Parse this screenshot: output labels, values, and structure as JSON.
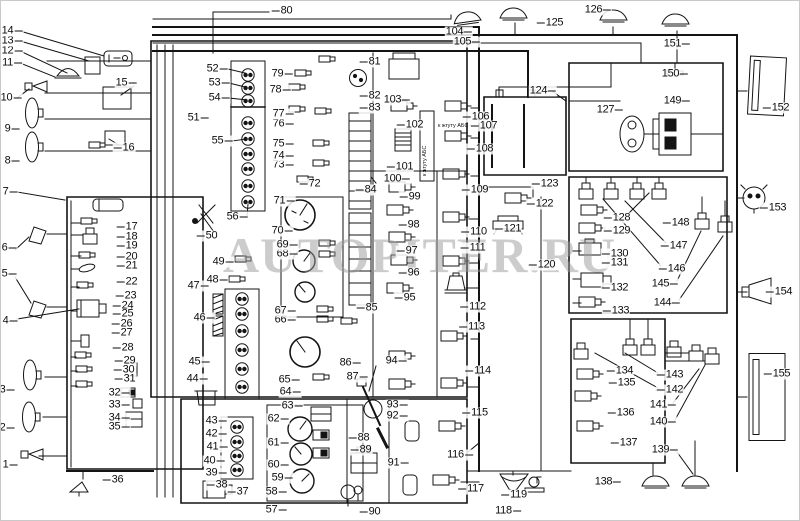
{
  "watermark": "AUTOPITER.RU",
  "colors": {
    "line": "#141414",
    "background": "#ffffff",
    "watermark": "#9a9a9a"
  },
  "annotations": [
    {
      "text": "к жгуту АБС",
      "x": 437,
      "y": 123,
      "rot": 0
    },
    {
      "text": "к жгуту АБС",
      "x": 422,
      "y": 175,
      "rot": -90
    }
  ],
  "labels": [
    {
      "n": "1",
      "x": 9,
      "y": 464,
      "s": "r"
    },
    {
      "n": "2",
      "x": 6,
      "y": 427,
      "s": "r"
    },
    {
      "n": "3",
      "x": 6,
      "y": 389,
      "s": "r"
    },
    {
      "n": "4",
      "x": 9,
      "y": 320,
      "s": "r"
    },
    {
      "n": "5",
      "x": 8,
      "y": 273,
      "s": "r"
    },
    {
      "n": "6",
      "x": 8,
      "y": 247,
      "s": "r"
    },
    {
      "n": "7",
      "x": 9,
      "y": 191,
      "s": "r"
    },
    {
      "n": "8",
      "x": 11,
      "y": 160,
      "s": "r"
    },
    {
      "n": "9",
      "x": 11,
      "y": 128,
      "s": "r"
    },
    {
      "n": "10",
      "x": 10,
      "y": 97,
      "s": "r"
    },
    {
      "n": "11",
      "x": 11,
      "y": 62,
      "s": "r"
    },
    {
      "n": "12",
      "x": 11,
      "y": 50,
      "s": "r"
    },
    {
      "n": "13",
      "x": 11,
      "y": 40,
      "s": "r"
    },
    {
      "n": "14",
      "x": 11,
      "y": 30,
      "s": "r"
    },
    {
      "n": "15",
      "x": 125,
      "y": 82,
      "s": "r"
    },
    {
      "n": "16",
      "x": 123,
      "y": 147,
      "s": "l"
    },
    {
      "n": "17",
      "x": 126,
      "y": 226,
      "s": "l"
    },
    {
      "n": "18",
      "x": 126,
      "y": 236,
      "s": "l"
    },
    {
      "n": "19",
      "x": 126,
      "y": 245,
      "s": "l"
    },
    {
      "n": "20",
      "x": 126,
      "y": 256,
      "s": "l"
    },
    {
      "n": "21",
      "x": 126,
      "y": 265,
      "s": "l"
    },
    {
      "n": "22",
      "x": 126,
      "y": 281,
      "s": "l"
    },
    {
      "n": "23",
      "x": 125,
      "y": 295,
      "s": "l"
    },
    {
      "n": "24",
      "x": 122,
      "y": 305,
      "s": "l"
    },
    {
      "n": "25",
      "x": 122,
      "y": 313,
      "s": "l"
    },
    {
      "n": "26",
      "x": 121,
      "y": 323,
      "s": "l"
    },
    {
      "n": "27",
      "x": 121,
      "y": 332,
      "s": "l"
    },
    {
      "n": "28",
      "x": 122,
      "y": 347,
      "s": "l"
    },
    {
      "n": "29",
      "x": 124,
      "y": 360,
      "s": "l"
    },
    {
      "n": "30",
      "x": 123,
      "y": 369,
      "s": "l"
    },
    {
      "n": "31",
      "x": 124,
      "y": 378,
      "s": "l"
    },
    {
      "n": "32",
      "x": 118,
      "y": 392,
      "s": "r"
    },
    {
      "n": "33",
      "x": 118,
      "y": 404,
      "s": "r"
    },
    {
      "n": "34",
      "x": 118,
      "y": 417,
      "s": "r"
    },
    {
      "n": "35",
      "x": 118,
      "y": 426,
      "s": "r"
    },
    {
      "n": "36",
      "x": 112,
      "y": 479,
      "s": "l"
    },
    {
      "n": "37",
      "x": 237,
      "y": 491,
      "s": "l"
    },
    {
      "n": "38",
      "x": 216,
      "y": 484,
      "s": "l"
    },
    {
      "n": "39",
      "x": 215,
      "y": 472,
      "s": "r"
    },
    {
      "n": "40",
      "x": 213,
      "y": 460,
      "s": "r"
    },
    {
      "n": "41",
      "x": 216,
      "y": 446,
      "s": "r"
    },
    {
      "n": "42",
      "x": 215,
      "y": 433,
      "s": "r"
    },
    {
      "n": "43",
      "x": 215,
      "y": 420,
      "s": "r"
    },
    {
      "n": "44",
      "x": 196,
      "y": 378,
      "s": "r"
    },
    {
      "n": "45",
      "x": 198,
      "y": 361,
      "s": "r"
    },
    {
      "n": "46",
      "x": 203,
      "y": 317,
      "s": "r"
    },
    {
      "n": "47",
      "x": 197,
      "y": 285,
      "s": "r"
    },
    {
      "n": "48",
      "x": 216,
      "y": 279,
      "s": "r"
    },
    {
      "n": "49",
      "x": 222,
      "y": 261,
      "s": "r"
    },
    {
      "n": "50",
      "x": 206,
      "y": 235,
      "s": "l"
    },
    {
      "n": "51",
      "x": 197,
      "y": 117,
      "s": "r"
    },
    {
      "n": "52",
      "x": 216,
      "y": 68,
      "s": "r"
    },
    {
      "n": "53",
      "x": 218,
      "y": 82,
      "s": "r"
    },
    {
      "n": "54",
      "x": 218,
      "y": 97,
      "s": "r"
    },
    {
      "n": "55",
      "x": 221,
      "y": 140,
      "s": "r"
    },
    {
      "n": "56",
      "x": 236,
      "y": 216,
      "s": "r"
    },
    {
      "n": "57",
      "x": 275,
      "y": 509,
      "s": "r"
    },
    {
      "n": "58",
      "x": 275,
      "y": 491,
      "s": "r"
    },
    {
      "n": "59",
      "x": 281,
      "y": 477,
      "s": "r"
    },
    {
      "n": "60",
      "x": 277,
      "y": 464,
      "s": "r"
    },
    {
      "n": "61",
      "x": 277,
      "y": 442,
      "s": "r"
    },
    {
      "n": "62",
      "x": 277,
      "y": 418,
      "s": "r"
    },
    {
      "n": "63",
      "x": 291,
      "y": 405,
      "s": "r"
    },
    {
      "n": "64",
      "x": 289,
      "y": 391,
      "s": "r"
    },
    {
      "n": "65",
      "x": 288,
      "y": 379,
      "s": "r"
    },
    {
      "n": "66",
      "x": 284,
      "y": 319,
      "s": "r"
    },
    {
      "n": "67",
      "x": 284,
      "y": 310,
      "s": "r"
    },
    {
      "n": "68",
      "x": 286,
      "y": 253,
      "s": "r"
    },
    {
      "n": "69",
      "x": 286,
      "y": 244,
      "s": "r"
    },
    {
      "n": "70",
      "x": 281,
      "y": 230,
      "s": "r"
    },
    {
      "n": "71",
      "x": 283,
      "y": 200,
      "s": "r"
    },
    {
      "n": "72",
      "x": 309,
      "y": 183,
      "s": "l"
    },
    {
      "n": "73",
      "x": 282,
      "y": 164,
      "s": "r"
    },
    {
      "n": "74",
      "x": 282,
      "y": 155,
      "s": "r"
    },
    {
      "n": "75",
      "x": 282,
      "y": 143,
      "s": "r"
    },
    {
      "n": "76",
      "x": 282,
      "y": 123,
      "s": "r"
    },
    {
      "n": "77",
      "x": 282,
      "y": 113,
      "s": "r"
    },
    {
      "n": "78",
      "x": 279,
      "y": 89,
      "s": "r"
    },
    {
      "n": "79",
      "x": 281,
      "y": 73,
      "s": "r"
    },
    {
      "n": "80",
      "x": 281,
      "y": 10,
      "s": "l"
    },
    {
      "n": "81",
      "x": 369,
      "y": 61,
      "s": "l"
    },
    {
      "n": "82",
      "x": 369,
      "y": 95,
      "s": "l"
    },
    {
      "n": "83",
      "x": 369,
      "y": 107,
      "s": "l"
    },
    {
      "n": "84",
      "x": 365,
      "y": 189,
      "s": "l"
    },
    {
      "n": "85",
      "x": 366,
      "y": 307,
      "s": "l"
    },
    {
      "n": "86",
      "x": 349,
      "y": 362,
      "s": "r"
    },
    {
      "n": "87",
      "x": 356,
      "y": 376,
      "s": "r"
    },
    {
      "n": "88",
      "x": 358,
      "y": 437,
      "s": "l"
    },
    {
      "n": "89",
      "x": 360,
      "y": 449,
      "s": "l"
    },
    {
      "n": "90",
      "x": 369,
      "y": 511,
      "s": "l"
    },
    {
      "n": "91",
      "x": 397,
      "y": 462,
      "s": "r"
    },
    {
      "n": "92",
      "x": 396,
      "y": 415,
      "s": "r"
    },
    {
      "n": "93",
      "x": 396,
      "y": 404,
      "s": "r"
    },
    {
      "n": "94",
      "x": 395,
      "y": 360,
      "s": "r"
    },
    {
      "n": "95",
      "x": 404,
      "y": 297,
      "s": "l"
    },
    {
      "n": "96",
      "x": 408,
      "y": 272,
      "s": "l"
    },
    {
      "n": "97",
      "x": 406,
      "y": 250,
      "s": "l"
    },
    {
      "n": "98",
      "x": 408,
      "y": 224,
      "s": "l"
    },
    {
      "n": "99",
      "x": 409,
      "y": 196,
      "s": "l"
    },
    {
      "n": "100",
      "x": 396,
      "y": 178,
      "s": "r"
    },
    {
      "n": "101",
      "x": 399,
      "y": 166,
      "s": "l"
    },
    {
      "n": "102",
      "x": 409,
      "y": 124,
      "s": "l"
    },
    {
      "n": "103",
      "x": 396,
      "y": 99,
      "s": "r"
    },
    {
      "n": "104",
      "x": 458,
      "y": 31,
      "s": "r"
    },
    {
      "n": "105",
      "x": 466,
      "y": 41,
      "s": "r"
    },
    {
      "n": "106",
      "x": 475,
      "y": 116,
      "s": "l"
    },
    {
      "n": "107",
      "x": 483,
      "y": 125,
      "s": "l"
    },
    {
      "n": "108",
      "x": 479,
      "y": 148,
      "s": "l"
    },
    {
      "n": "109",
      "x": 474,
      "y": 189,
      "s": "l"
    },
    {
      "n": "110",
      "x": 473,
      "y": 231,
      "s": "l"
    },
    {
      "n": "111",
      "x": 472,
      "y": 247,
      "s": "l"
    },
    {
      "n": "112",
      "x": 472,
      "y": 306,
      "s": "l"
    },
    {
      "n": "113",
      "x": 471,
      "y": 326,
      "s": "l"
    },
    {
      "n": "114",
      "x": 477,
      "y": 370,
      "s": "l"
    },
    {
      "n": "115",
      "x": 474,
      "y": 412,
      "s": "l"
    },
    {
      "n": "116",
      "x": 459,
      "y": 454,
      "s": "r"
    },
    {
      "n": "117",
      "x": 470,
      "y": 488,
      "s": "l"
    },
    {
      "n": "118",
      "x": 507,
      "y": 510,
      "s": "r"
    },
    {
      "n": "119",
      "x": 513,
      "y": 494,
      "s": "l"
    },
    {
      "n": "120",
      "x": 541,
      "y": 264,
      "s": "l"
    },
    {
      "n": "121",
      "x": 507,
      "y": 228,
      "s": "l"
    },
    {
      "n": "122",
      "x": 539,
      "y": 203,
      "s": "l"
    },
    {
      "n": "123",
      "x": 544,
      "y": 183,
      "s": "l"
    },
    {
      "n": "124",
      "x": 542,
      "y": 90,
      "s": "r"
    },
    {
      "n": "125",
      "x": 549,
      "y": 22,
      "s": "l"
    },
    {
      "n": "126",
      "x": 597,
      "y": 9,
      "s": "r"
    },
    {
      "n": "127",
      "x": 609,
      "y": 109,
      "s": "r"
    },
    {
      "n": "128",
      "x": 616,
      "y": 217,
      "s": "l"
    },
    {
      "n": "129",
      "x": 616,
      "y": 230,
      "s": "l"
    },
    {
      "n": "130",
      "x": 614,
      "y": 253,
      "s": "l"
    },
    {
      "n": "131",
      "x": 614,
      "y": 262,
      "s": "l"
    },
    {
      "n": "132",
      "x": 614,
      "y": 287,
      "s": "l"
    },
    {
      "n": "133",
      "x": 615,
      "y": 310,
      "s": "l"
    },
    {
      "n": "134",
      "x": 619,
      "y": 370,
      "s": "l"
    },
    {
      "n": "135",
      "x": 621,
      "y": 382,
      "s": "l"
    },
    {
      "n": "136",
      "x": 620,
      "y": 412,
      "s": "l"
    },
    {
      "n": "137",
      "x": 623,
      "y": 442,
      "s": "l"
    },
    {
      "n": "138",
      "x": 607,
      "y": 481,
      "s": "r"
    },
    {
      "n": "139",
      "x": 664,
      "y": 449,
      "s": "r"
    },
    {
      "n": "140",
      "x": 662,
      "y": 421,
      "s": "r"
    },
    {
      "n": "141",
      "x": 662,
      "y": 404,
      "s": "r"
    },
    {
      "n": "142",
      "x": 669,
      "y": 389,
      "s": "l"
    },
    {
      "n": "143",
      "x": 669,
      "y": 374,
      "s": "l"
    },
    {
      "n": "144",
      "x": 666,
      "y": 302,
      "s": "r"
    },
    {
      "n": "145",
      "x": 664,
      "y": 283,
      "s": "r"
    },
    {
      "n": "146",
      "x": 671,
      "y": 268,
      "s": "l"
    },
    {
      "n": "147",
      "x": 673,
      "y": 245,
      "s": "l"
    },
    {
      "n": "148",
      "x": 675,
      "y": 222,
      "s": "l"
    },
    {
      "n": "149",
      "x": 676,
      "y": 100,
      "s": "r"
    },
    {
      "n": "150",
      "x": 674,
      "y": 73,
      "s": "r"
    },
    {
      "n": "151",
      "x": 676,
      "y": 43,
      "s": "r"
    },
    {
      "n": "152",
      "x": 775,
      "y": 107,
      "s": "l"
    },
    {
      "n": "153",
      "x": 772,
      "y": 207,
      "s": "l"
    },
    {
      "n": "154",
      "x": 778,
      "y": 291,
      "s": "l"
    },
    {
      "n": "155",
      "x": 776,
      "y": 373,
      "s": "l"
    }
  ]
}
